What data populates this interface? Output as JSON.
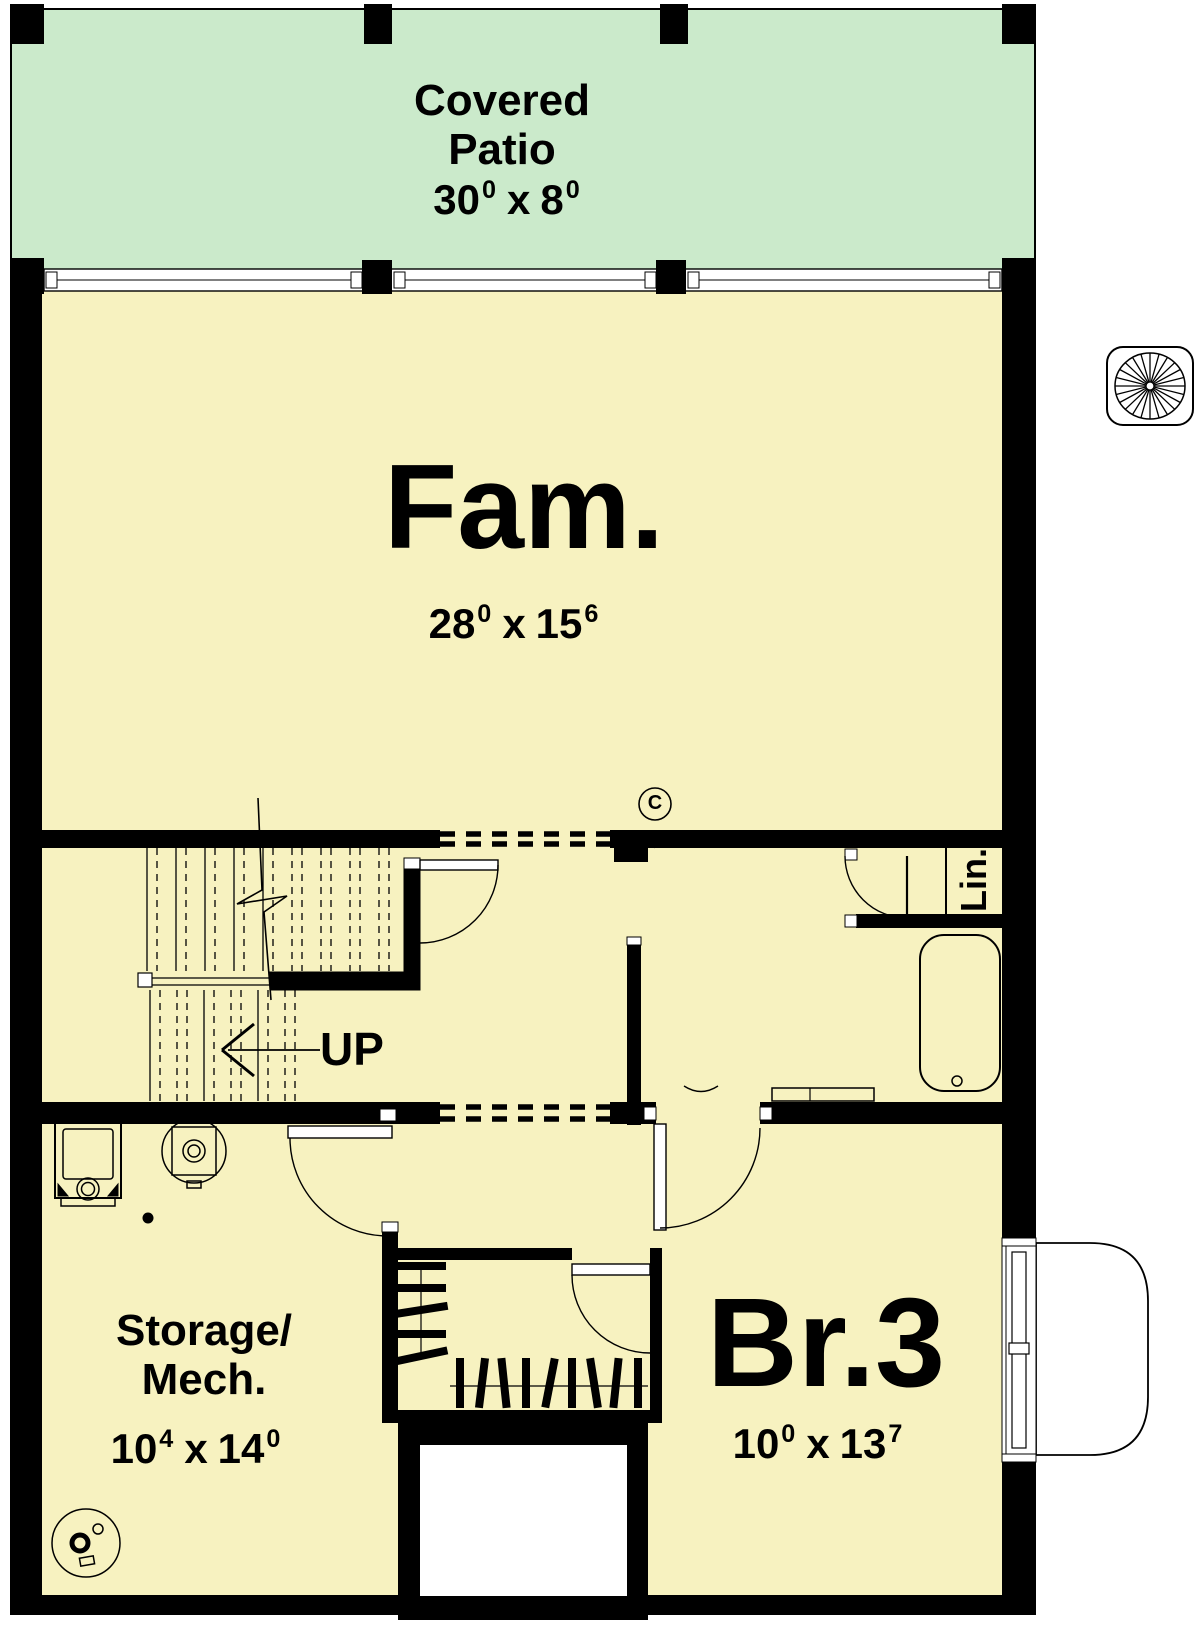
{
  "plan": {
    "patio": {
      "line1": "Covered",
      "line2": "Patio",
      "dim": {
        "a": "30",
        "a_sup": "0",
        "sep": "x",
        "b": "8",
        "b_sup": "0"
      }
    },
    "fam": {
      "name": "Fam.",
      "dim": {
        "a": "28",
        "a_sup": "0",
        "sep": "x",
        "b": "15",
        "b_sup": "6"
      }
    },
    "stairs": {
      "up_label": "UP"
    },
    "linen": {
      "label": "Lin."
    },
    "ceiling_marker": "C",
    "storage": {
      "line1": "Storage/",
      "line2": "Mech.",
      "dim": {
        "a": "10",
        "a_sup": "4",
        "sep": "x",
        "b": "14",
        "b_sup": "0"
      }
    },
    "br3": {
      "name": "Br.3",
      "dim": {
        "a": "10",
        "a_sup": "0",
        "sep": "x",
        "b": "13",
        "b_sup": "7"
      }
    }
  },
  "icons": {
    "compass_rose": "radial-spokes-in-rounded-square",
    "furnace": "square-appliance-symbol",
    "water_heater": "circle-with-square-symbol",
    "sump_pump": "circle-with-pump-symbol",
    "floor_drain": "filled-dot",
    "bathtub": "rounded-rect-with-drain",
    "clothes_rod": "rod-with-hanger-bars"
  },
  "colors": {
    "patio_fill": "#cbeacb",
    "room_fill": "#f7f2c0",
    "wall": "#000000",
    "page": "#ffffff"
  }
}
